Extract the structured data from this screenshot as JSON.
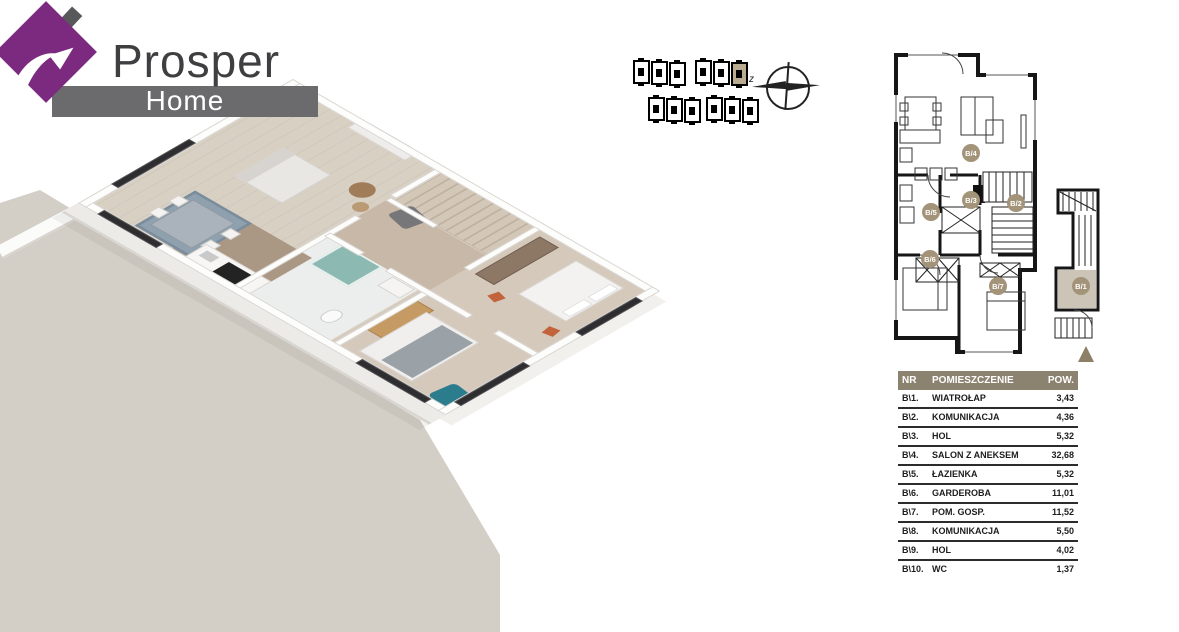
{
  "brand": {
    "name_top": "Prosper",
    "name_bottom": "Home",
    "house_color": "#7c2a7f",
    "banner_color": "#6b6a6c",
    "text_color": "#3f3e40"
  },
  "compass": {
    "west_label": "z"
  },
  "site_map": {
    "description": "two rows of small building outline icons",
    "row1_groups": [
      3,
      3
    ],
    "row2_groups": [
      3,
      3
    ],
    "highlighted_building": "row 1, group 2, building 3",
    "highlight_color": "#b9ac90"
  },
  "plan2d": {
    "labels": [
      "B/4",
      "B/3",
      "B/2",
      "B/5",
      "B/6",
      "B/7"
    ],
    "annex_label": "B/1",
    "label_bg": "#a29379",
    "annex_room_fill": "#ccc5b7",
    "arrow_color": "#8c8066"
  },
  "legend_table": {
    "headers": {
      "nr": "NR",
      "room": "POMIESZCZENIE",
      "area": "POW."
    },
    "header_bg": "#8c8270",
    "rows": [
      {
        "nr": "B\\1.",
        "room": "WIATROŁAP",
        "area": "3,43"
      },
      {
        "nr": "B\\2.",
        "room": "KOMUNIKACJA",
        "area": "4,36"
      },
      {
        "nr": "B\\3.",
        "room": "HOL",
        "area": "5,32"
      },
      {
        "nr": "B\\4.",
        "room": "SALON Z ANEKSEM",
        "area": "32,68"
      },
      {
        "nr": "B\\5.",
        "room": "ŁAZIENKA",
        "area": "5,32"
      },
      {
        "nr": "B\\6.",
        "room": "GARDEROBA",
        "area": "11,01"
      },
      {
        "nr": "B\\7.",
        "room": "POM. GOSP.",
        "area": "11,52"
      },
      {
        "nr": "B\\8.",
        "room": "KOMUNIKACJA",
        "area": "5,50"
      },
      {
        "nr": "B\\9.",
        "room": "HOL",
        "area": "4,02"
      },
      {
        "nr": "B\\10.",
        "room": "WC",
        "area": "1,37"
      }
    ]
  },
  "palette": {
    "ground": "#d3cec6",
    "floor": "#d9d0c4",
    "dark_wood_floor": "#ab9884",
    "wardrobe_brown": "#8d7866",
    "desk_tan": "#c69b63",
    "teal_chair": "#2b7c8d",
    "orange_chair": "#c2633c",
    "window_frame": "#2e2e30"
  }
}
